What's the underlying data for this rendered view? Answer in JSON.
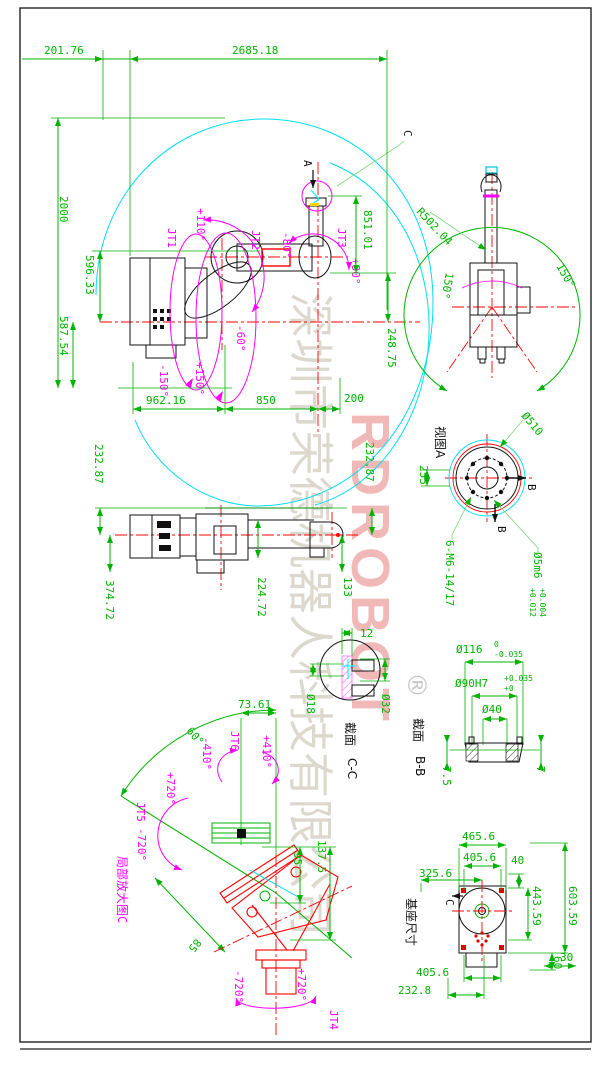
{
  "colors": {
    "dimension": "#00b300",
    "joint_motion": "#ff00ff",
    "envelope": "#00dff0",
    "centerline": "#ff0000",
    "outline": "#111111",
    "watermark_gray": "#d6d2c6",
    "watermark_red": "#e57373"
  },
  "fv": {
    "d1": "201.76",
    "d2": "2685.18",
    "d3": "2000",
    "d4": "596.33",
    "d5": "587.54",
    "d6": "962.16",
    "d7": "850",
    "d8": "200",
    "d9": "851.01",
    "d10": "248.75",
    "jt1": "JT1",
    "jt2": "JT2",
    "jt3": "JT3",
    "a1": "+110°",
    "a2": "-80°",
    "a3": "-60°",
    "a4": "+90°",
    "a5": "-150°",
    "a6": "+150°",
    "va": "A",
    "vc": "C"
  },
  "tv": {
    "r": "R502.04",
    "a1": "150°",
    "a2": "150°"
  },
  "sv": {
    "d1": "232.87",
    "d2": "374.72",
    "d3": "224.72",
    "d4": "133",
    "d5": "232.87"
  },
  "fl": {
    "t": "视图A",
    "d1": "Ø510",
    "d2": "255",
    "b1": "B",
    "b2": "B",
    "bolts": "6-M6-14/17",
    "pin": "Ø5m6",
    "pt1": "+0.012",
    "pt2": "+0.004"
  },
  "cc": {
    "t": "截面",
    "n": "C-C",
    "d1": "12",
    "d2": "Ø18",
    "d3": "Ø32"
  },
  "bb": {
    "t": "截面",
    "n": "B-B",
    "d1": "Ø116",
    "d1u": "0",
    "d1l": "-0.035",
    "d2": "Ø90H7",
    "d2u": "+0.035",
    "d2l": "+0",
    "d3": "Ø40",
    "d4": "7.5",
    "d5": "7"
  },
  "dc": {
    "t": "局部放大图C",
    "d1": "73.61",
    "d2": "95",
    "d3": "137.5",
    "d4": "85",
    "d5": "60°",
    "jt4": "JT4",
    "jt5": "JT5",
    "jt6": "JT6",
    "a4p": "+720°",
    "a4n": "-720°",
    "a5p": "+720°",
    "a5n": "-720°",
    "a6p": "+410°",
    "a6n": "-410°"
  },
  "bv": {
    "t": "基座尺寸",
    "d1": "465.6",
    "d2": "405.6",
    "d3": "40",
    "d4": "325.6",
    "d5": "443.59",
    "d6": "603.59",
    "d7": "30",
    "d8": "60",
    "d9": "405.6",
    "d10": "232.8",
    "c": "C"
  },
  "wm": {
    "company": "深圳市荣德机器人科技有限公司",
    "brand": "RDROBOT",
    "reg": "®"
  }
}
